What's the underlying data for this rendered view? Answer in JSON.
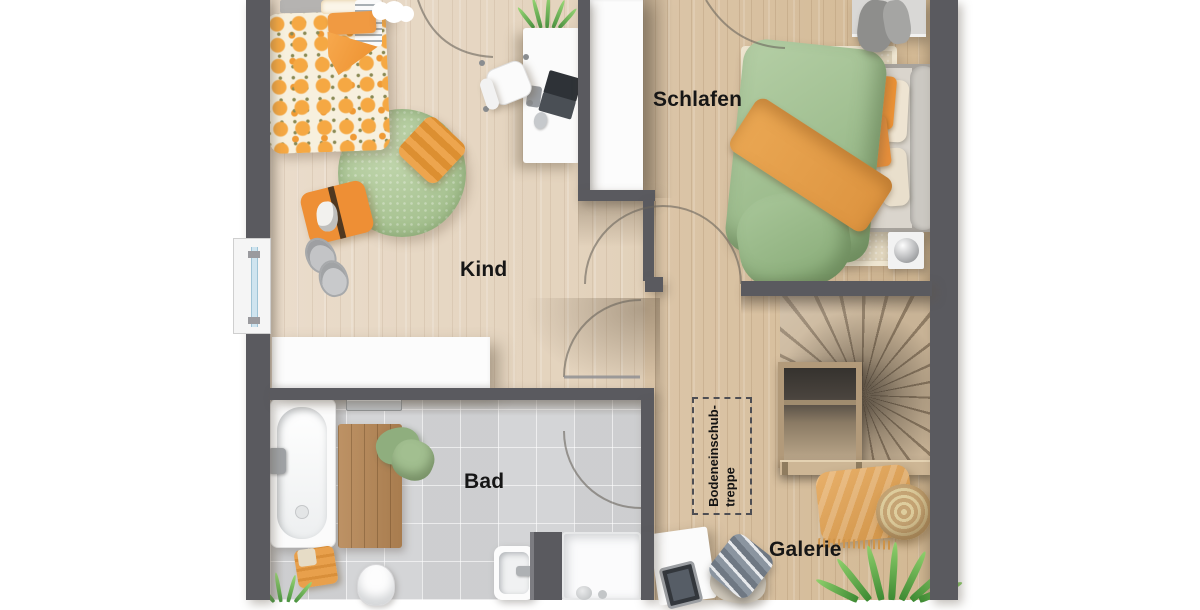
{
  "floorplan": {
    "rooms": {
      "kind": {
        "label": "Kind"
      },
      "schlafen": {
        "label": "Schlafen"
      },
      "bad": {
        "label": "Bad"
      },
      "galerie": {
        "label": "Galerie"
      }
    },
    "annotations": {
      "attic_hatch": {
        "line1": "Bodeneinschub-",
        "line2": "treppe"
      }
    },
    "colors": {
      "wall": "#5a5a5f",
      "floor_light_wood": "#e8dac7",
      "floor_warm_wood": "#d9c2a3",
      "bath_tile": "#d4d5d7",
      "accent_orange": "#f09a42",
      "accent_green": "#a9c69b",
      "label_text": "#161616"
    }
  }
}
